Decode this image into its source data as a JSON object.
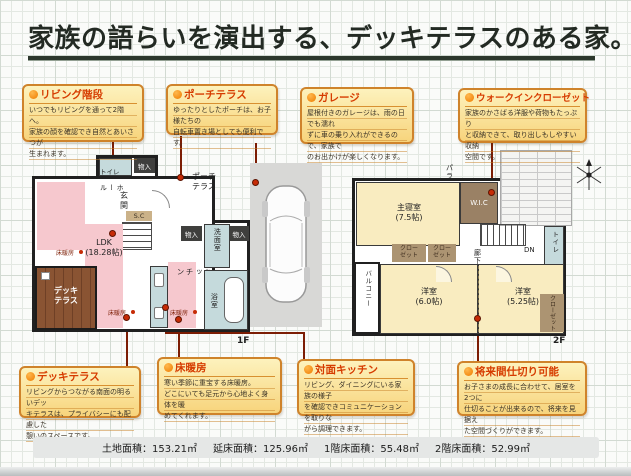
{
  "title": {
    "text": "家族の語らいを演出する、デッキテラスのある家。"
  },
  "callouts": [
    {
      "id": "living-stairs",
      "title": "リビング階段",
      "body": "いつでもリビングを通って2階へ。\n家族の顔を確認でき自然とあいさつが\n生まれます。"
    },
    {
      "id": "porch-terrace",
      "title": "ポーチテラス",
      "body": "ゆったりとしたポーチは、お子様たちの\n自転車置き場としても便利です。"
    },
    {
      "id": "garage",
      "title": "ガレージ",
      "body": "屋根付きのガレージは、雨の日でも濡れ\nずに車の乗り入れができるので、家族で\nのお出かけが楽しくなります。"
    },
    {
      "id": "walk-in-closet",
      "title": "ウォークインクローゼット",
      "body": "家族のかさばる洋服や荷物もたっぷり\nと収納できて、取り出しもしやすい収納\n空間です。"
    },
    {
      "id": "deck-terrace",
      "title": "デッキテラス",
      "body": "リビングからつながる南面の明るいデッ\nキテラスは、プライバシーにも配慮した\n憩いのスペースです。"
    },
    {
      "id": "floor-heating",
      "title": "床暖房",
      "body": "寒い季節に重宝する床暖房。\nどこにいても足元から心地よく身体を暖\nめてくれます。"
    },
    {
      "id": "counter-kitchen",
      "title": "対面キッチン",
      "body": "リビング、ダイニングにいる家族の様子\nを確認できコミュニケーションを取りな\nがら調理できます。"
    },
    {
      "id": "future-partition",
      "title": "将来間仕切り可能",
      "body": "お子さまの成長に合わせて、居室を2つに\n仕切ることが出来るので、将来を見据え\nた空間づくりができます。"
    }
  ],
  "floor1": {
    "label": "1F",
    "toilet": "トイレ",
    "storage": "物入",
    "hall": "ホール",
    "entrance": "玄関",
    "shoe_closet": "S.C",
    "up": "UP",
    "porch": "ポーチ\nテラス",
    "ldk": "LDK\n(18.28帖)",
    "floor_heating": "床暖房",
    "kitchen": "キッチン",
    "washroom": "洗面室",
    "bathroom": "浴室",
    "deck": "デッキ\nテラス"
  },
  "floor2": {
    "label": "2F",
    "master_bedroom": "主寝室\n(7.5帖)",
    "wic": "W.I.C",
    "parapet": "パラペット",
    "closet": "クロー\nゼット",
    "hallway": "廊下",
    "dn": "DN",
    "toilet": "トイレ",
    "balcony": "バルコニー",
    "bedroom_a": "洋室\n(6.0帖)",
    "bedroom_b": "洋室\n(5.25帖)",
    "closet_vertical": "クローゼット"
  },
  "footer": {
    "items": [
      "土地面積：153.21㎡",
      "延床面積：125.96㎡",
      "1階床面積：55.48㎡",
      "2階床面積：52.99㎡"
    ]
  },
  "colors": {
    "title_red": "#d63c00",
    "box_border": "#cf832b",
    "box_bg_top": "#fdf2bd",
    "box_bg_bottom": "#f7d47c",
    "connector": "#7c1d04",
    "ldk_pink": "#f6c8ce",
    "room_cream": "#f9ecc0",
    "wet_teal": "#c5dadc",
    "deck_brown": "#84502f",
    "garage_gray": "#d8d8d6"
  }
}
